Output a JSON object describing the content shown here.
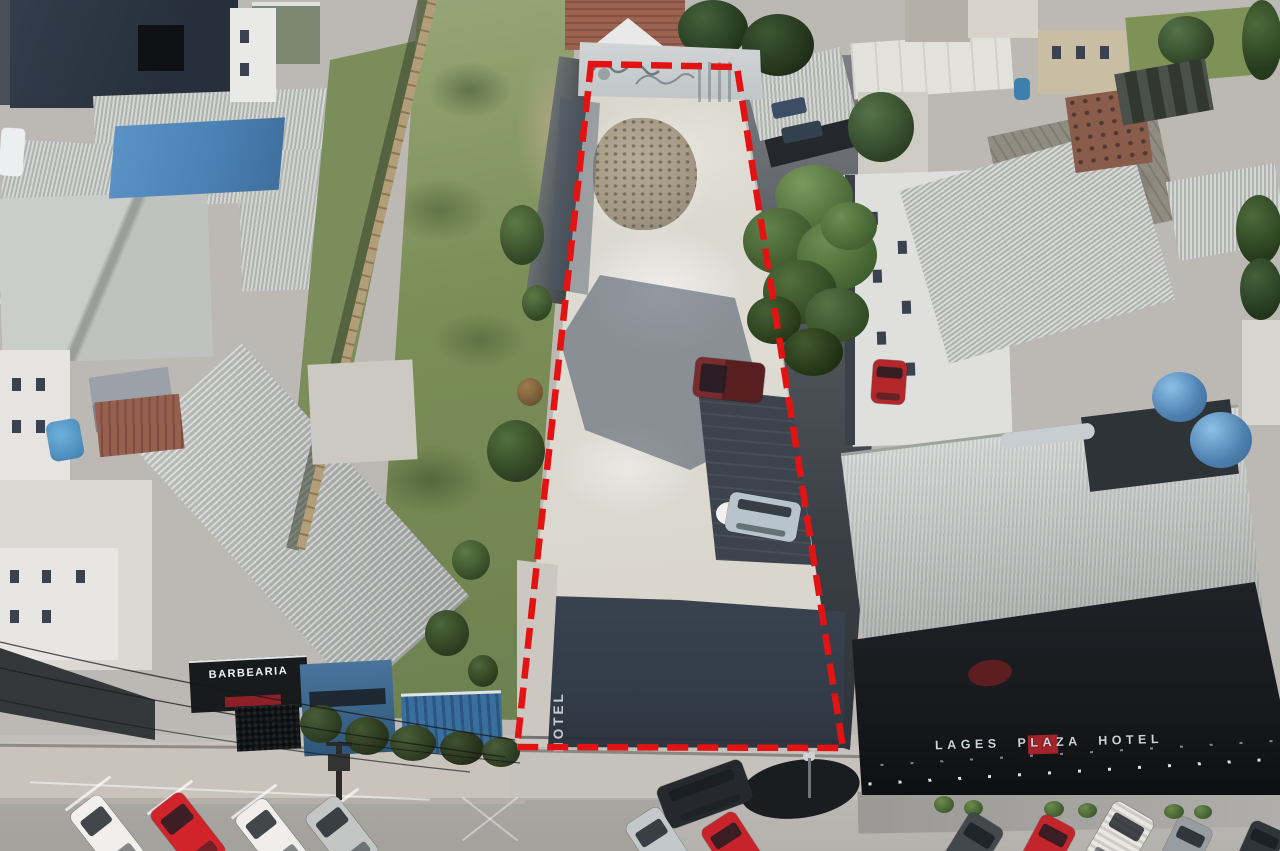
{
  "scene": {
    "type": "aerial-drone-photo",
    "subject": "narrow vacant urban lot marked with a red dashed property boundary, between a barbershop building and the Lages Plaza Hotel, cars parked on the street below"
  },
  "signs": {
    "barbershop": "BARBEARIA",
    "hotel": "LAGES PLAZA HOTEL",
    "pavement": "HOTEL"
  },
  "boundary": {
    "color": "#e41313",
    "stroke_width": 6.5,
    "dash_pattern": "21 9",
    "vertices": [
      [
        591,
        64
      ],
      [
        737,
        67
      ],
      [
        843,
        748
      ],
      [
        517,
        747
      ]
    ]
  },
  "colors": {
    "street": "#bcb9b4",
    "sidewalk": "#c9c3bc",
    "gravel": "#dedbd3",
    "grass": "#8b9c6b",
    "shadow": "#333d49",
    "roof_gray": "#c2c4c1",
    "roof_navy": "#2c3542",
    "tarp_blue": "#4a80b3",
    "hotel_black": "#17191d",
    "brick_wall": "#b29e78",
    "tank_blue": "#4d7fae",
    "alley": "#575c62",
    "wall_white": "#d2d5d5",
    "rubble": "#a39884",
    "sign_red": "#a2232a",
    "barber_red": "#8c2026"
  },
  "vehicles": {
    "lot_pickup": {
      "type": "pickup-truck",
      "color": "#7b2b2d"
    },
    "lot_car": {
      "type": "hatchback",
      "color": "#b7c4cb"
    },
    "alley_car": {
      "type": "car",
      "color": "#b3272b"
    },
    "street_left": [
      {
        "color": "#f0efec"
      },
      {
        "color": "#d0242a"
      },
      {
        "color": "#efeeeb"
      },
      {
        "color": "#c3c6c5"
      }
    ],
    "street_center": [
      {
        "color": "#c3c9cb"
      },
      {
        "color": "#c8232a"
      }
    ],
    "street_right": [
      {
        "color": "#43484c"
      },
      {
        "color": "#c2262c"
      },
      {
        "color": "#e8e7e2"
      },
      {
        "color": "#979da0"
      },
      {
        "color": "#30353a"
      }
    ]
  }
}
